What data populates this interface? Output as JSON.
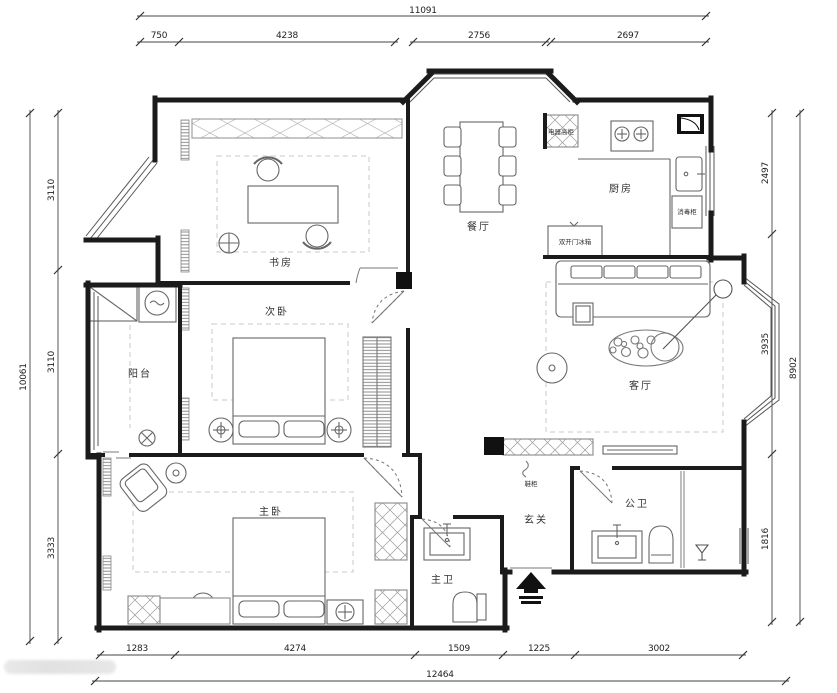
{
  "drawing": {
    "background": "#ffffff",
    "wall_color": "#1b1b1b",
    "furniture_color": "#666666",
    "dimension_color": "#333333"
  },
  "rooms": {
    "study": "书房",
    "dining": "餐厅",
    "kitchen": "厨房",
    "living": "客厅",
    "balcony": "阳台",
    "second_bedroom": "次卧",
    "master_bedroom": "主卧",
    "master_bath": "主卫",
    "entry": "玄关",
    "public_bath": "公卫"
  },
  "fixtures": {
    "tall_appliance_cabinet": "电器高柜",
    "fridge": "双开门冰箱",
    "sterilizer_cabinet": "消毒柜",
    "shoe_cabinet": "鞋柜"
  },
  "dimensions": {
    "top": {
      "total": "11091",
      "segments": [
        "750",
        "4238",
        "2756",
        "2697"
      ]
    },
    "bottom": {
      "total": "12464",
      "segments": [
        "1283",
        "4274",
        "1509",
        "1225",
        "3002"
      ]
    },
    "left": {
      "total": "10061",
      "segments": [
        "3110",
        "3110",
        "3333"
      ]
    },
    "right": {
      "total": "8902",
      "segments": [
        "2497",
        "3935",
        "1816"
      ]
    }
  }
}
